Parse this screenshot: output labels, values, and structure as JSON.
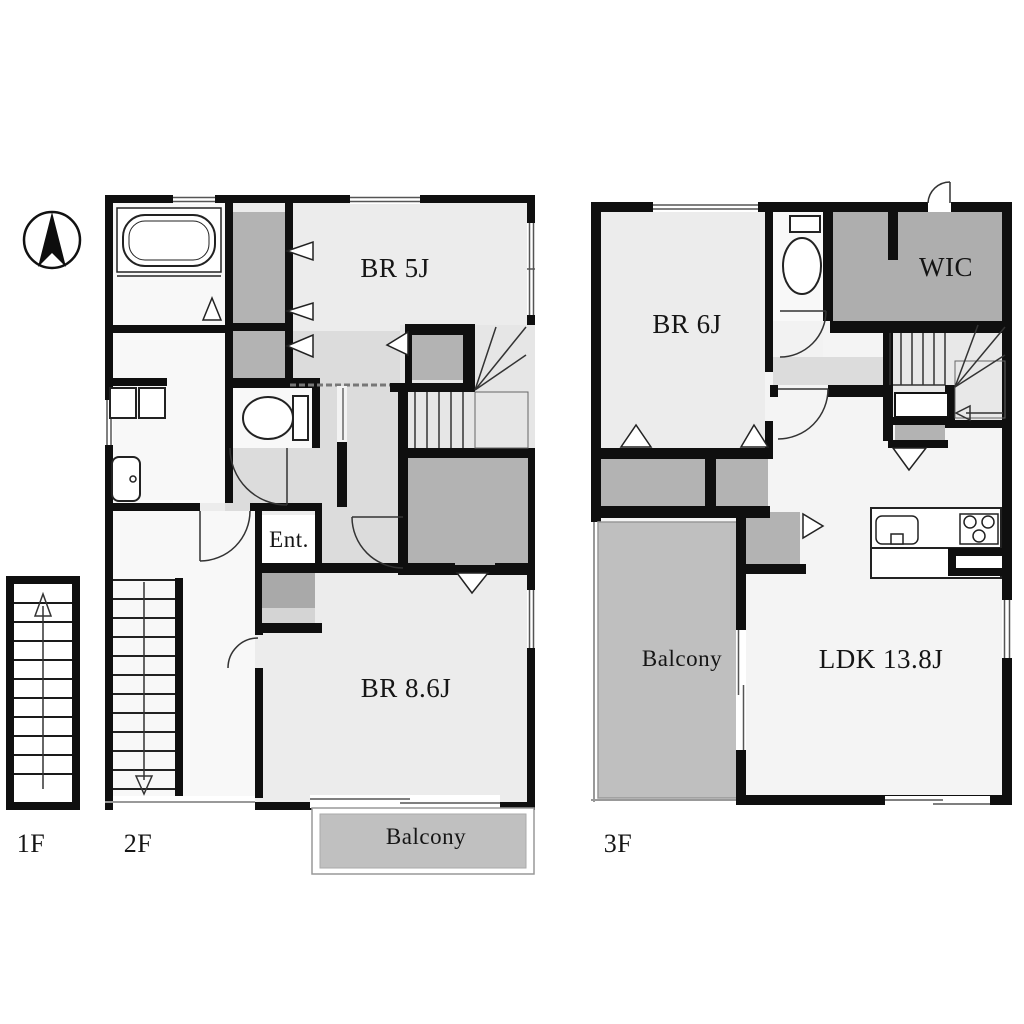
{
  "title": "Apartment floor plan 1F/2F/3F",
  "compass": {
    "icon": "north-arrow"
  },
  "floors": {
    "f1": {
      "label": "1F"
    },
    "f2": {
      "label": "2F",
      "rooms": {
        "br5": "BR 5J",
        "ent": "Ent.",
        "br86": "BR 8.6J",
        "balcony": "Balcony"
      }
    },
    "f3": {
      "label": "3F",
      "rooms": {
        "br6": "BR 6J",
        "wic": "WIC",
        "balcony": "Balcony",
        "ldk": "LDK 13.8J"
      }
    }
  },
  "colors": {
    "wall": "#111111",
    "room_light": "#ececec",
    "room_white": "#f8f8f8",
    "hall": "#dcdcdc",
    "closet_gray": "#b3b3b3",
    "balcony_gray": "#c0c0c0"
  }
}
